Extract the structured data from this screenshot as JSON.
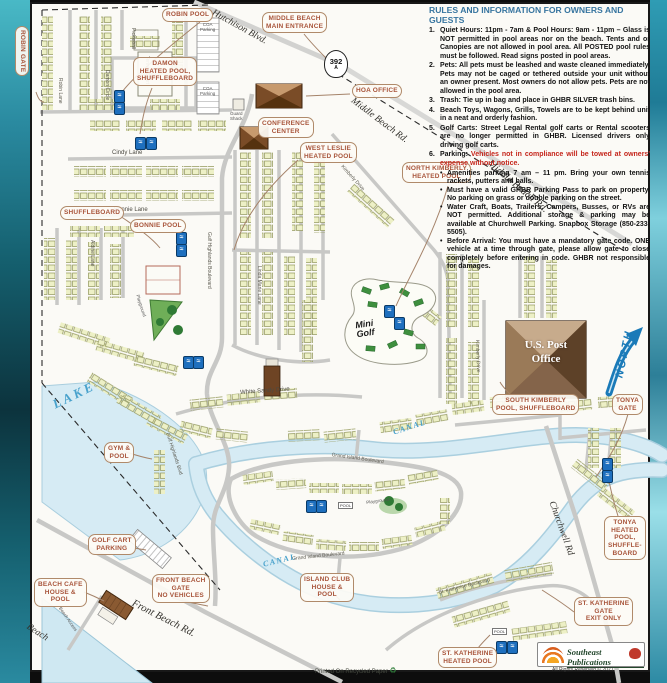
{
  "rules": {
    "title": "RULES AND INFORMATION FOR OWNERS AND GUESTS",
    "items": [
      {
        "num": "1.",
        "lead": "Quiet Hours:",
        "mid": " 11pm - 7am & ",
        "lead2": "Pool Hours:",
        "body": " 9am - 11pm – Glass is NOT permitted in pool areas nor on the beach. Tents and or Canopies are not allowed in pool area. All POSTED pool rules must be followed. Read signs posted in pool areas."
      },
      {
        "num": "2.",
        "lead": "Pets:",
        "body": " All pets must be leashed and waste cleaned immediately. Pets may not be caged or tethered outside your unit without an owner present. Most owners do not allow pets. Pets are not allowed in the pool area."
      },
      {
        "num": "3.",
        "lead": "Trash:",
        "body": " Tie up in bag and place in GHBR SILVER trash bins."
      },
      {
        "num": "4.",
        "lead": "",
        "body": "Beach Toys, Wagons, Grills, Towels are to be kept behind unit in a neat and orderly fashion."
      },
      {
        "num": "5.",
        "lead": "Golf Carts:",
        "body": " Street Legal Rental golf carts or Rental scooters are no longer permitted in GHBR. Licensed drivers only driving golf carts."
      },
      {
        "num": "6.",
        "lead": "Parking:",
        "warning": " Vehicles not in compliance will be towed at owners' expense without notice.",
        "bullets": [
          {
            "lead": "",
            "text": "Amenities parking 7 am – 11 pm. Bring your own tennis rackets, putters and balls."
          },
          {
            "lead": "",
            "text": "Must have a valid GHBR Parking Pass to park on property. No parking on grass or double parking on the street."
          },
          {
            "lead": "",
            "text": "Water Craft, Boats, Trailers, Campers, Busses, or RVs are NOT permitted. Additional storage & parking may be available at Churchwell Parking. Snapbox Storage (850-233-5505)."
          },
          {
            "lead": "Before Arrival:",
            "text": " You must have a mandatory gate code. ONE vehicle at a time through gate, please allow gate to close completely before entering in code. GHBR not responsible for damages."
          }
        ]
      }
    ]
  },
  "labels": {
    "robin_pool": "ROBIN POOL",
    "robin_gate": "ROBIN GATE",
    "middle_beach_entrance": "MIDDLE BEACH\nMAIN ENTRANCE",
    "damon_pool": "DAMON\nHEATED POOL,\nSHUFFLEBOARD",
    "hoa_office": "HOA OFFICE",
    "conference_center": "CONFERENCE\nCENTER",
    "west_leslie": "WEST LESLIE\nHEATED POOL",
    "north_kimberly": "NORTH KIMBERLY\nHEATED POOL",
    "shuffleboard": "SHUFFLEBOARD",
    "bonnie_pool": "BONNIE POOL",
    "gym_pool": "GYM &\nPOOL",
    "south_kimberly": "SOUTH KIMBERLY\nPOOL, SHUFFLEBOARD",
    "tonya_gate": "TONYA\nGATE",
    "tonya_pool": "TONYA\nHEATED\nPOOL,\nSHUFFLE-\nBOARD",
    "st_katherine_gate": "ST. KATHERINE\nGATE\nEXIT ONLY",
    "st_katherine_pool": "ST. KATHERINE\nHEATED POOL",
    "island_club": "ISLAND CLUB\nHOUSE &\nPOOL",
    "front_beach_gate": "FRONT BEACH\nGATE\nNO VEHICLES",
    "golf_cart_parking": "GOLF CART\nPARKING",
    "beach_cafe": "BEACH CAFE\nHOUSE &\nPOOL"
  },
  "streets": {
    "hutchison": "Hutchison Blvd.",
    "middle_beach": "Middle Beach Rd.",
    "cindy": "Cindy Lane",
    "bonnie": "Bonnie Lane",
    "gulf_highlands": "Gulf Highlands Boulevard",
    "gulf_highlands_short": "Gulf Highlands Blvd",
    "kimberly": "Kimberly Drive",
    "white_sandy": "White Sandy Drive",
    "grand_island": "Grand Island Boulevard",
    "churchwell": "Churchwell Rd",
    "front_beach": "Front Beach Rd.",
    "st_katherine": "St. Katherine Boulevard",
    "robin": "Robin Lane",
    "damon": "Damon Circle",
    "aldine": "Aldine Lane",
    "linda_marie": "Linda Marie Lane",
    "tennis": "Tennis Court",
    "pickleball": "Pickleball",
    "beach": "Beach"
  },
  "map_texts": {
    "lake": "LAKE",
    "canal": "CANAL",
    "north": "NORTH",
    "mini_golf": "Mini\nGolf",
    "playground": "Playground",
    "post_office": "U.S. Post\nOffice",
    "guard_shack": "Guard\nShack",
    "coa_parking": "COA\nParking",
    "beach_access": "Beach Access",
    "pool_box": "POOL",
    "highway_shield": "392",
    "highway_suffix": "A",
    "printed": "Printed On Recycled Paper",
    "publisher": "Southeast Publications",
    "rights": "All Rights Reserved © 2021"
  },
  "icons": {
    "pool": "≈",
    "recycle": "♻"
  },
  "colors": {
    "callout_text": "#a8543a",
    "callout_border": "#b08a6a",
    "rules_title_blue": "#36749f",
    "warning_red": "#c5261c",
    "water": "#d6ebf4",
    "building_fill": "#edf0c6",
    "north_blue": "#1a7ab8"
  }
}
